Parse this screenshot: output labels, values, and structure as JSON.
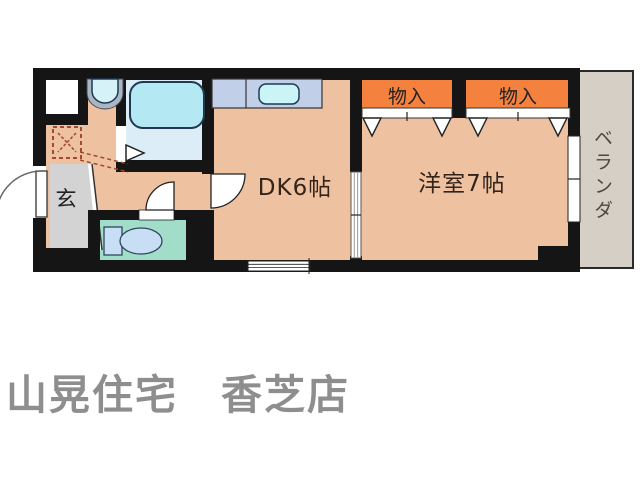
{
  "floor_plan": {
    "labels": {
      "dining_kitchen": "DK6帖",
      "western_room": "洋室7帖",
      "storage_left": "物入",
      "storage_right": "物入",
      "veranda": "ベランダ",
      "entrance": "玄"
    },
    "colors": {
      "wall": "#151515",
      "floor": "#eec2a0",
      "storage": "#f5813f",
      "toilet_floor": "#a2ddc9",
      "bathroom_floor": "#dcedf8",
      "bathtub": "#b4e8f3",
      "kitchen_counter": "#c1cfe9",
      "sink": "#caf4f6",
      "toilet_fixture": "#c7def4",
      "entrance_floor": "#d3d3d3",
      "veranda_floor": "#d6cfc6"
    }
  },
  "footer": {
    "company": "山晃住宅　香芝店",
    "text_color": "#8e8e8e"
  }
}
